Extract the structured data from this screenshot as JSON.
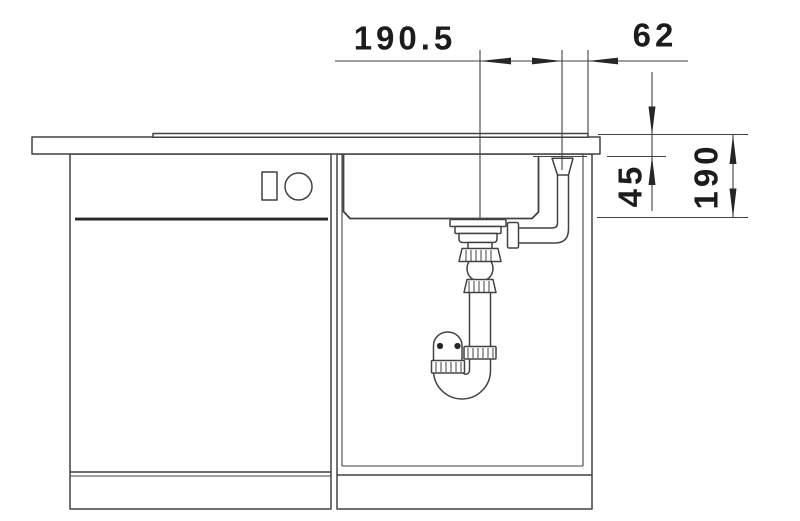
{
  "canvas": {
    "width": 800,
    "height": 521
  },
  "colors": {
    "line": "#424242",
    "dark": "#262626",
    "text": "#1c1c1c",
    "background": "#ffffff"
  },
  "drawing": {
    "kind": "sink-installation-section"
  },
  "dimensions": {
    "drain_center_offset": "190.5",
    "overflow_to_edge": "62",
    "overflow_drop": "45",
    "bowl_depth": "190"
  }
}
